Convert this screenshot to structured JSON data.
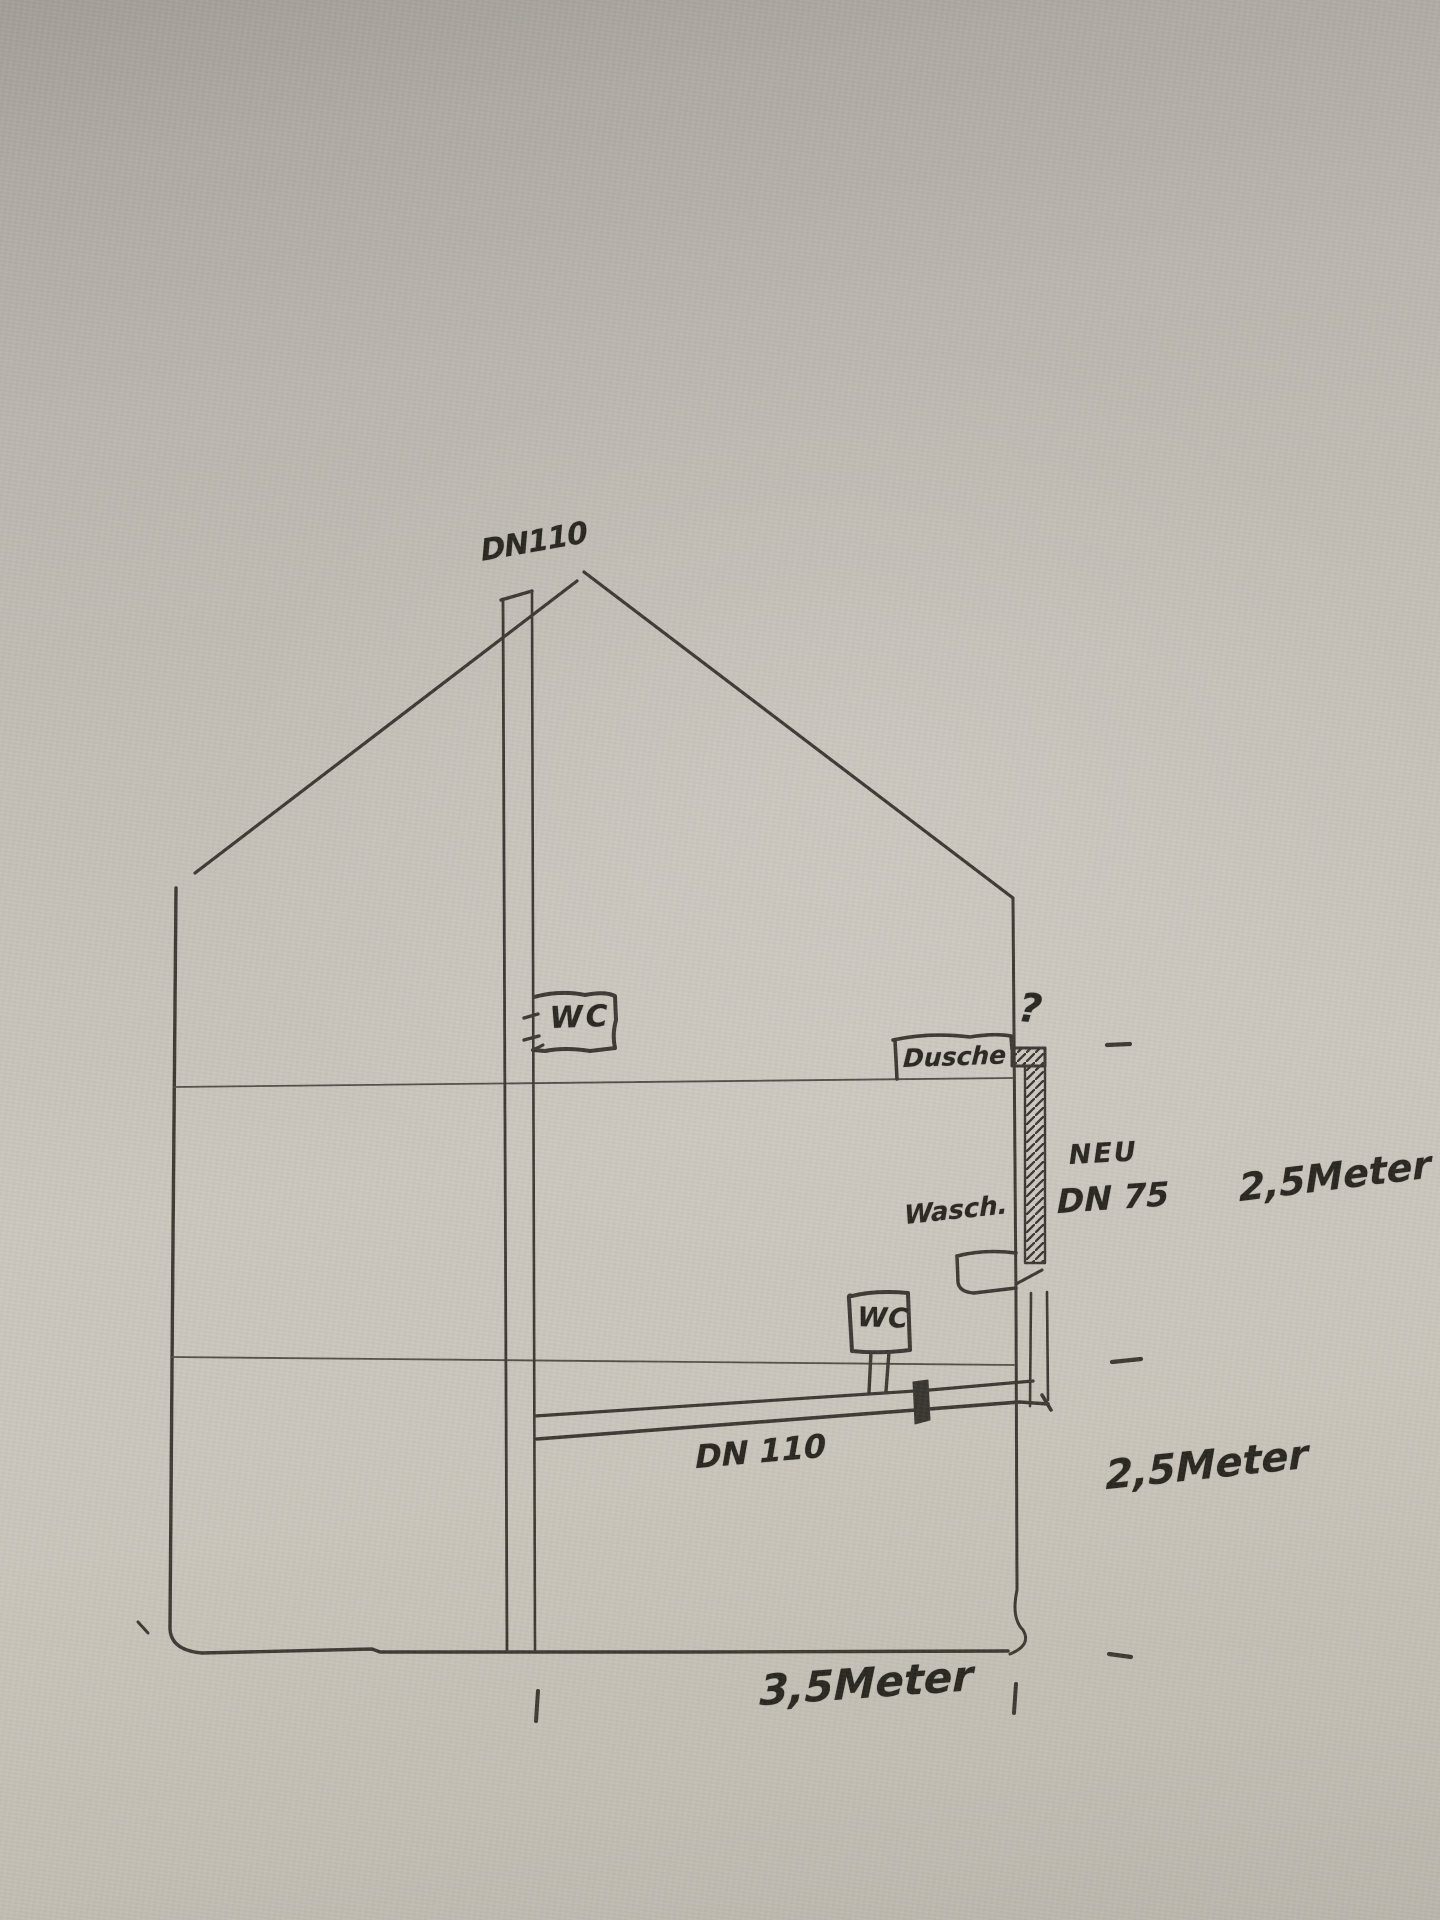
{
  "page": {
    "description": "Hand-drawn pen sketch on grey paper: cross-section of a house showing the DN110 soil stack through the roof, an upstairs WC, a shower (Dusche) and washbasin (Wasch.) connected by a new DN 75 drop pipe to a sloped DN 110 ground-floor pipe, with storey heights of 2,5 Meter and a width of 3,5 Meter"
  },
  "colors": {
    "paper": "#c5c0b7",
    "ink": "#2e2a25"
  },
  "labels": {
    "roof_vent": "DN110",
    "upper_wc": "WC",
    "dusche": "Dusche",
    "question": "?",
    "neu": "NEU",
    "dn75": "DN 75",
    "height_upper": "2,5Meter",
    "wasch": "Wasch.",
    "lower_wc": "WC",
    "ground_pipe": "DN 110",
    "height_lower": "2,5Meter",
    "width_bottom": "3,5Meter"
  }
}
